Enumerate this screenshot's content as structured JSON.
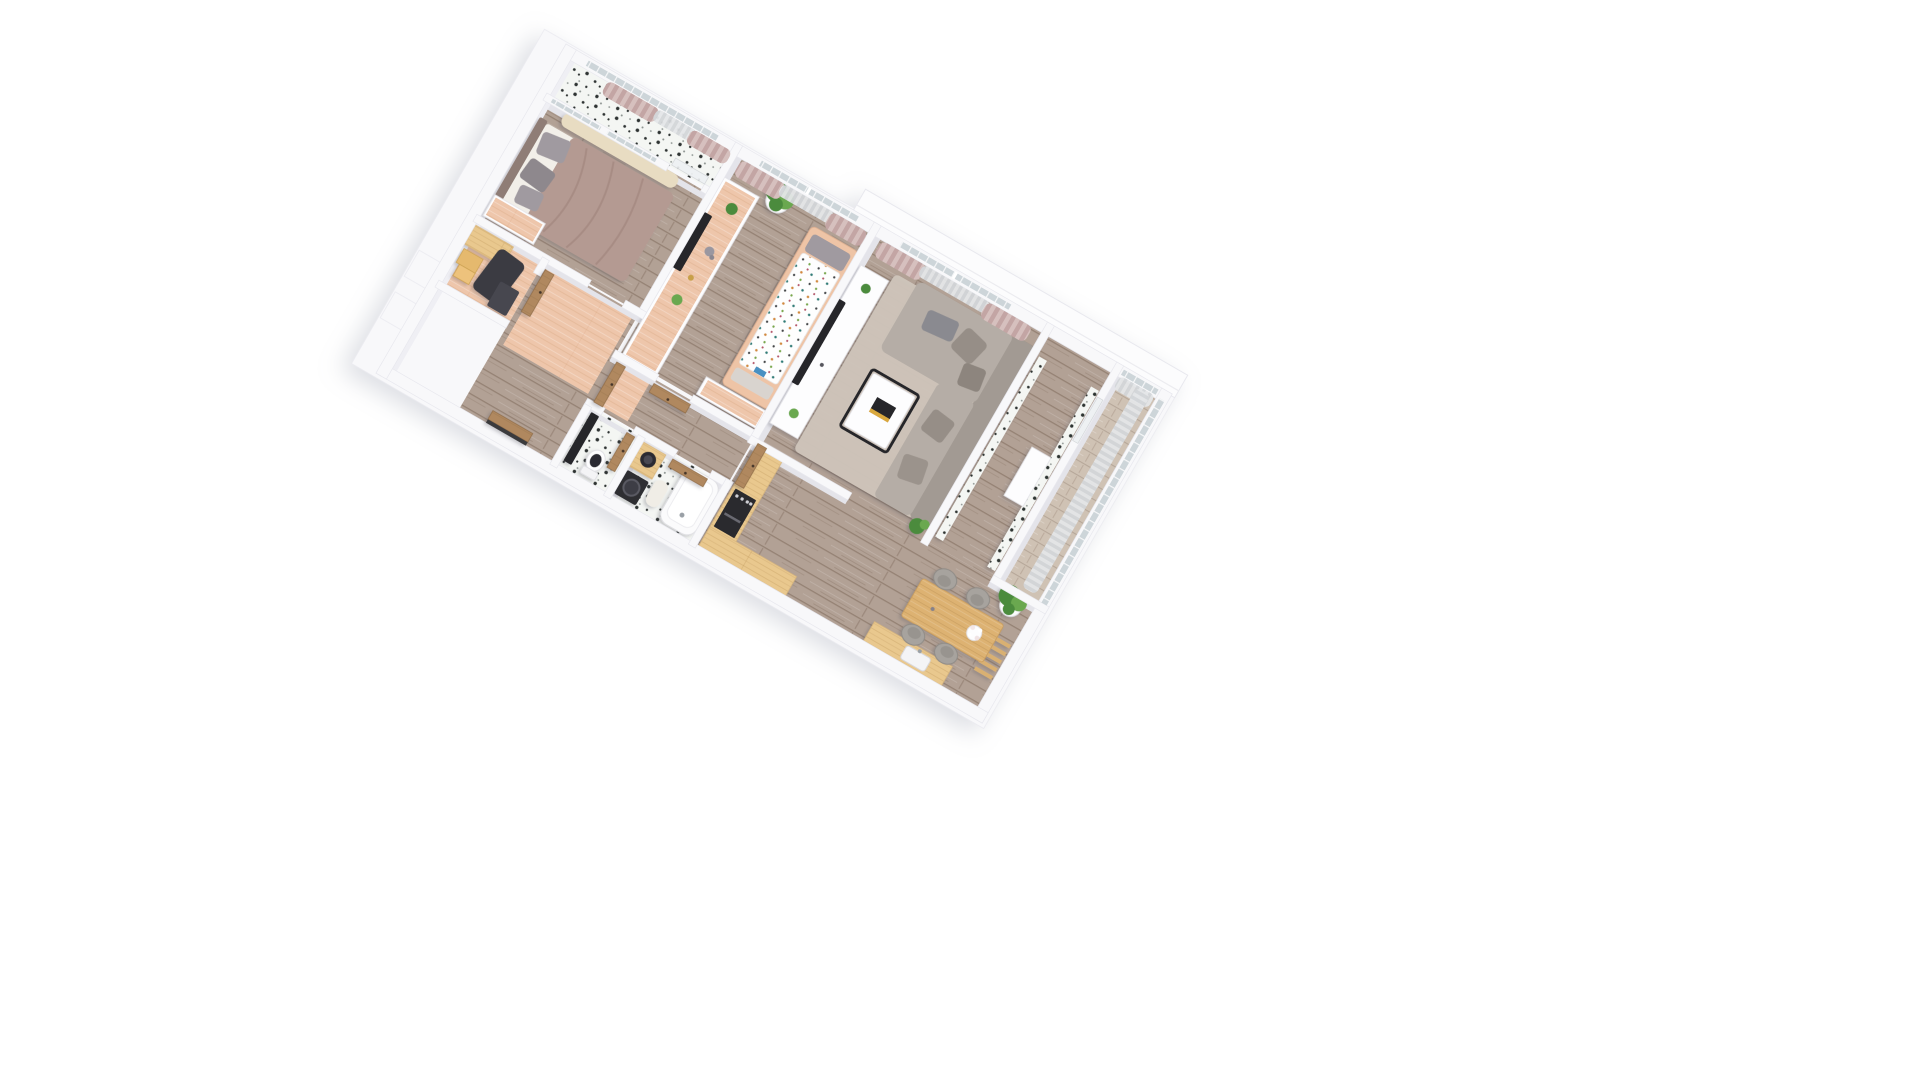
{
  "scene": {
    "title": "3D isometric apartment floor-plan render",
    "view": "top-down axonometric, plan rotated ~30 degrees clockwise",
    "background": "#ffffff",
    "text_visible_in_image": "none"
  },
  "palette": {
    "wall": "#f8f8fa",
    "wall-face": "#e4e4ea",
    "wall-face-light": "#efeff4",
    "wall-edge": "#e8e8ee",
    "terrace": "#fcfcfd",
    "wood-base": "#b2a195",
    "wood-line": "#6d5747",
    "wood-light": "#cfc2b4",
    "salmon": "#eec6ab",
    "salmon-line": "#cf9872",
    "counter": "#e9c88e",
    "counter-line": "#a87c3f",
    "table-wood": "#ddb272",
    "door-wood": "#b0885f",
    "door-edge": "#8f6c47",
    "terrazzo": "#f4f6f3",
    "speck": "#2f3433",
    "speck-soft": "#8a918e",
    "pink": "#c3a5a4",
    "pink-2": "#d6c0be",
    "sheer": "#d3d6d9",
    "sheer-2": "#e4e6e8",
    "glass": "#c6cfd4",
    "bed": "#b49a92",
    "bed-dark": "#9c8279",
    "headboard": "#8f7d76",
    "pillow": "#a09aa0",
    "pillow-2": "#8e888d",
    "runner": "#e8dcc2",
    "sofa": "#b5ada6",
    "sofa-back": "#a29a93",
    "cushion": "#968e87",
    "rug": "#cfc5ba",
    "tv": "#26262a",
    "green": "#4c8b3c",
    "green-2": "#6aa84f",
    "pot": "#fcfcfd",
    "chair": "#a7a39e",
    "appliance": "#2b2b2f",
    "white": "#fdfdfe",
    "mat": "#f0ede6"
  },
  "rooms": [
    {
      "id": "bedroom",
      "name": "bedroom",
      "floor": "wood"
    },
    {
      "id": "bedroom-loggia",
      "name": "bedroom loggia",
      "floor": "terrazzo with pink curtains"
    },
    {
      "id": "wardrobe",
      "name": "wardrobe closet",
      "floor": "salmon"
    },
    {
      "id": "hallway",
      "name": "hallway",
      "floor": "wood with salmon runners"
    },
    {
      "id": "kids-room",
      "name": "kids room",
      "floor": "wood with salmon desk band"
    },
    {
      "id": "living-room",
      "name": "living room",
      "floor": "wood with beige rug"
    },
    {
      "id": "vestibule",
      "name": "tiled vestibule",
      "floor": "wood, speckled tile walls"
    },
    {
      "id": "loggia",
      "name": "glazed loggia",
      "floor": "light wood, sheer curtains"
    },
    {
      "id": "kitchen-dining",
      "name": "kitchen and dining",
      "floor": "wood"
    },
    {
      "id": "wc",
      "name": "WC",
      "floor": "terrazzo"
    },
    {
      "id": "bathroom",
      "name": "bathroom",
      "floor": "terrazzo"
    }
  ],
  "furniture": {
    "bedroom": [
      "double-bed-mauve-duvet",
      "gray-pillows",
      "wood-headboard",
      "cream-runner-rug",
      "salmon-top-dresser"
    ],
    "wardrobe": [
      "plywood-desk",
      "hanging-dark-clothes",
      "wood-storage-boxes",
      "dark-cabinet"
    ],
    "kids-room": [
      "wall-mounted-tv",
      "salmon-top-console",
      "elephant-figurine",
      "mini-plants",
      "large-potted-plant",
      "child-bed-dotted-duvet",
      "salmon-top-desk"
    ],
    "living-room": [
      "wall-mounted-tv",
      "white-media-console",
      "console-plants",
      "beige-area-rug",
      "l-shaped-gray-sofa",
      "scatter-cushions",
      "black-frame-coffee-table",
      "book-with-yellow-band",
      "window-radiator",
      "corner-plant"
    ],
    "vestibule": [
      "speckled-tile-wall-panels",
      "white-wall-shelf"
    ],
    "kitchen-dining": [
      "l-shaped-light-wood-counter",
      "built-in-oven",
      "sink-counter",
      "wood-dining-table",
      "four-gray-chairs",
      "white-flower-bouquet",
      "potted-plant-white-pot",
      "wall-ladder-rack"
    ],
    "bathroom": [
      "white-bathtub",
      "wood-vanity-round-black-basin",
      "washing-machine",
      "fluffy-bath-mat"
    ],
    "wc": [
      "black-counter",
      "toilet"
    ],
    "loggia": [
      "sheer-curtains",
      "mullioned-glazing"
    ]
  },
  "openings": {
    "windows": [
      "bedroom-loggia-glazing",
      "kids-room-window",
      "living-room-window",
      "loggia-glazing-top",
      "loggia-glazing-right"
    ],
    "doors": [
      "front-door",
      "bedroom-door",
      "corridor-door",
      "kids-room-door",
      "kitchen-door",
      "bathroom-door",
      "wc-door",
      "loggia-glass-door",
      "bedroom-balcony-glass-door"
    ]
  },
  "curtains": {
    "pink": "dusty-pink drapes on bedroom, kids and living windows",
    "sheer": "light gray sheers on loggias"
  }
}
